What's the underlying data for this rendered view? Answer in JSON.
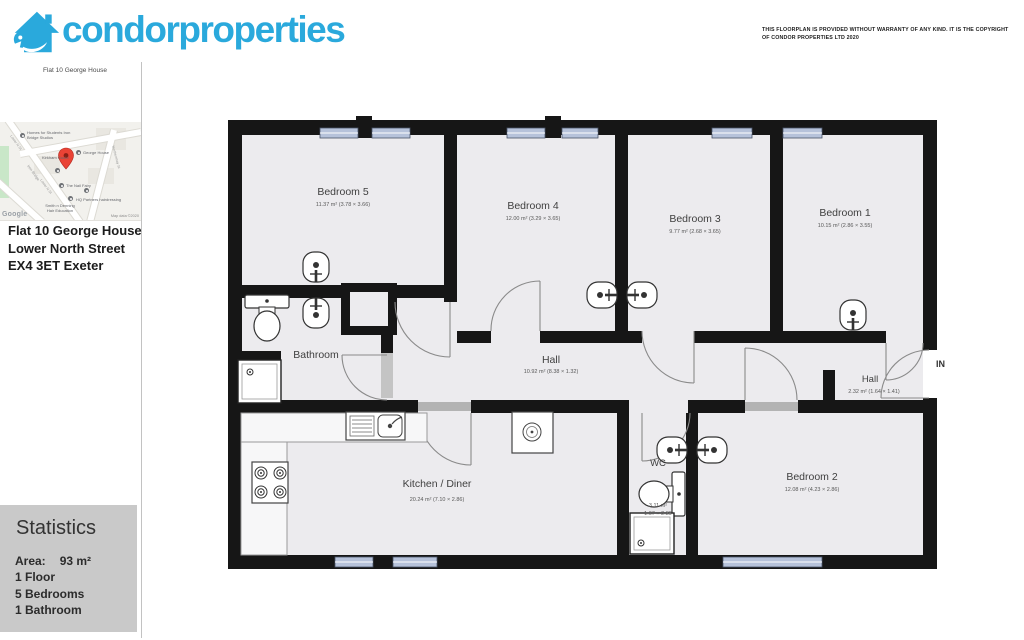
{
  "brand": {
    "name_part1": "condor",
    "name_part2": "properties",
    "color": "#2aa9dc"
  },
  "disclaimer": "THIS FLOORPLAN IS PROVIDED WITHOUT WARRANTY OF ANY KIND. IT IS THE COPYRIGHT OF CONDOR PROPERTIES LTD 2020",
  "sidebar": {
    "property_ref": "Flat 10 George House",
    "map": {
      "pins": [
        "Homes for Students Iron Bridge Studios",
        "George House",
        "Kirkham Gould",
        "The Nail Fairy",
        "HQ Partners hairdressing",
        "Smith n Denning Hair Education"
      ],
      "roads": [
        "Lower N St",
        "Iron Bridge",
        "Lower N St",
        "Northernhay St"
      ],
      "google_label": "Google",
      "map_data_label": "Map data ©2020"
    },
    "address_lines": [
      "Flat 10 George House",
      "Lower North Street",
      "EX4 3ET Exeter"
    ],
    "statistics": {
      "title": "Statistics",
      "area_label": "Area:",
      "area_value": "93 m²",
      "floors": "1 Floor",
      "bedrooms": "5 Bedrooms",
      "bathrooms": "1 Bathroom"
    }
  },
  "floorplan": {
    "entry_label": "IN",
    "rooms": {
      "bedroom5": {
        "name": "Bedroom 5",
        "dims": "11.37 m² (3.78 × 3.66)"
      },
      "bedroom4": {
        "name": "Bedroom 4",
        "dims": "12.00 m² (3.29 × 3.65)"
      },
      "bedroom3": {
        "name": "Bedroom 3",
        "dims": "9.77 m² (2.68 × 3.65)"
      },
      "bedroom1": {
        "name": "Bedroom 1",
        "dims": "10.15 m² (2.86 × 3.55)"
      },
      "bedroom2": {
        "name": "Bedroom 2",
        "dims": "12.08 m² (4.23 × 2.86)"
      },
      "bathroom": {
        "name": "Bathroom"
      },
      "hall": {
        "name": "Hall",
        "dims": "10.92 m² (8.38 × 1.32)"
      },
      "hall2": {
        "name": "Hall",
        "dims": "2.32 m² (1.64 × 1.41)"
      },
      "kitchen": {
        "name": "Kitchen / Diner",
        "dims": "20.24 m² (7.10 × 2.86)"
      },
      "wc": {
        "name": "WC",
        "dims_line1": "3.11 m²",
        "dims_line2": "1.07 × 2.89"
      }
    }
  }
}
